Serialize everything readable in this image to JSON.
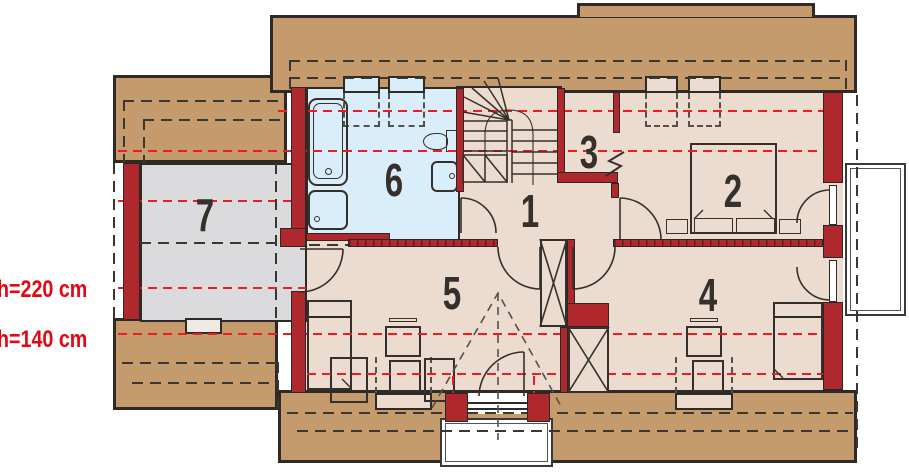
{
  "rooms": {
    "r1": "1",
    "r2": "2",
    "r3": "3",
    "r4": "4",
    "r5": "5",
    "r6": "6",
    "r7": "7"
  },
  "height_labels": {
    "h220": "h=220 cm",
    "h140": "h=140 cm"
  },
  "colors": {
    "roof_band": "#C59B6D",
    "wall_brick": "#AF282D",
    "floor": "#EBDCCF",
    "bathroom_floor": "#D9EDFB",
    "storage_floor": "#DBDBDE",
    "outline": "#2E2B27",
    "height_line_red": "#EC1C24",
    "balcony": "#FFFFFF"
  }
}
